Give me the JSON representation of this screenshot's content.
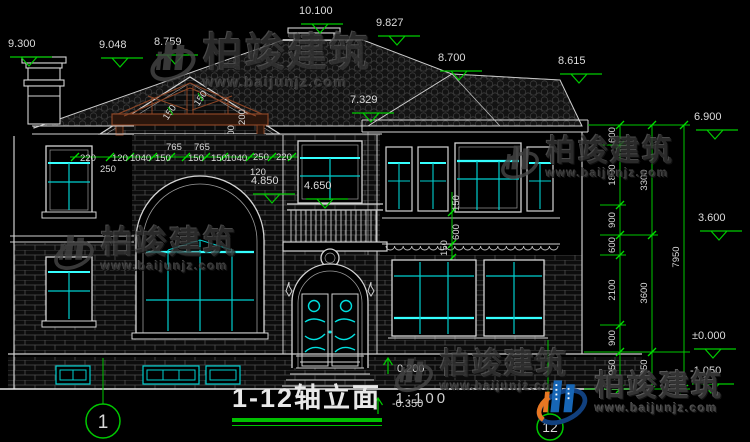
{
  "title": {
    "name": "1-12轴立面",
    "scale": "1:100"
  },
  "axis": {
    "left": "1",
    "right": "12"
  },
  "watermark": {
    "brand": "柏竣建筑",
    "url": "www.baijunjz.com"
  },
  "elevations": {
    "e9300": "9.300",
    "e9048": "9.048",
    "e8759": "8.759",
    "e10100": "10.100",
    "e9827": "9.827",
    "e8700": "8.700",
    "e8615": "8.615",
    "e7329": "7.329",
    "e6900": "6.900",
    "e4850": "4.850",
    "e4650": "4.650",
    "e3600": "3.600",
    "e0000": "±0.000",
    "em1050": "-1.050",
    "e0200": "0.200",
    "em0350": "-0.350"
  },
  "dims": {
    "gable_above": [
      "765",
      "765"
    ],
    "gable_row": [
      "220",
      "120",
      "1040",
      "150",
      "150",
      "150",
      "1040",
      "250",
      "220"
    ],
    "gable_below": [
      "250",
      "120"
    ],
    "truss": [
      "150",
      "150",
      "200",
      "300"
    ],
    "bay": [
      "150",
      "600",
      "150"
    ],
    "right_col1": [
      "600",
      "1800",
      "900",
      "600",
      "2100",
      "900",
      "1050"
    ],
    "right_col2": [
      "3300",
      "3600",
      "1050"
    ],
    "right_col3": [
      "7950"
    ]
  },
  "colors": {
    "background": "#000000",
    "line_white": "#d4d4d4",
    "glass_cyan": "#00e6e6",
    "dim_green": "#00c800",
    "truss_brown": "#8a4526",
    "watermark_gray": "#3a3a3a",
    "logo_blue": "#1766b5",
    "logo_orange": "#e87722"
  }
}
